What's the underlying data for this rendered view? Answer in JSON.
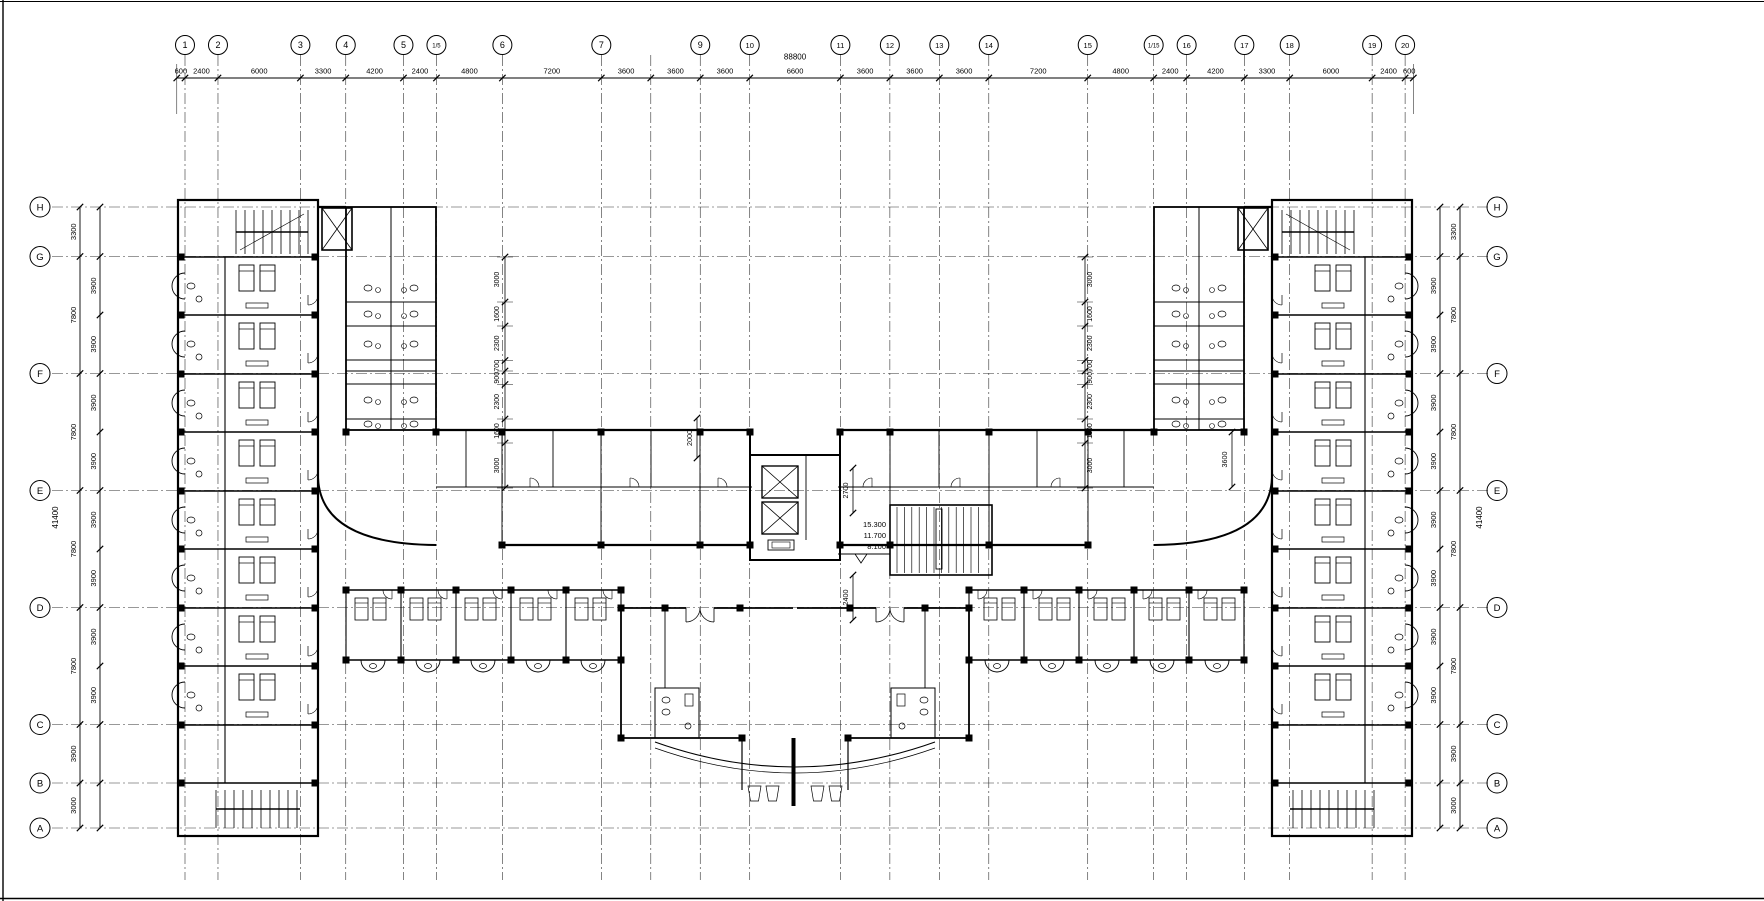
{
  "drawing": {
    "background": "#ffffff",
    "line_color": "#000000",
    "top_row": {
      "overall_label": "88800",
      "dim_labels": [
        "600",
        "2400",
        "6000",
        "3300",
        "4200",
        "2400",
        "4800",
        "7200",
        "3600",
        "3600",
        "3600",
        "6600",
        "3600",
        "3600",
        "3600",
        "7200",
        "4800",
        "2400",
        "4200",
        "3300",
        "6000",
        "2400",
        "600"
      ],
      "axis_labels": [
        "1",
        "2",
        "3",
        "4",
        "5",
        "1/5",
        "6",
        "7",
        "",
        "9",
        "10",
        "11",
        "12",
        "13",
        "14",
        "15",
        "1/15",
        "16",
        "17",
        "18",
        "19",
        "20"
      ],
      "axis_segments": [
        2400,
        6000,
        3300,
        4200,
        2400,
        4800,
        7200,
        3600,
        3600,
        3600,
        6600,
        3600,
        3600,
        3600,
        7200,
        4800,
        2400,
        4200,
        3300,
        6000,
        2400
      ],
      "end_extension": 600
    },
    "side_rows": {
      "axis_labels": [
        "H",
        "G",
        "F",
        "E",
        "D",
        "C",
        "B",
        "A"
      ],
      "axis_segments": [
        3300,
        7800,
        7800,
        7800,
        7800,
        3900,
        3000
      ],
      "outer_dim_labels": [
        "3300",
        "7800",
        "7800",
        "7800",
        "7800",
        "3900",
        "3000"
      ],
      "inner_dim_labels": [
        "3900",
        "3900",
        "3900",
        "3900",
        "3900",
        "3900",
        "3900",
        "3900"
      ],
      "overall_label": "41400"
    },
    "service_chain_labels": [
      "3000",
      "1600",
      "2300",
      "700",
      "900",
      "2300",
      "1600",
      "3000"
    ],
    "core": {
      "level_labels": [
        "15.300",
        "11.700",
        "8.100"
      ],
      "dim_2000": "2000",
      "dim_2700": "2700",
      "dim_2400": "2400",
      "dim_3600": "3600"
    }
  }
}
